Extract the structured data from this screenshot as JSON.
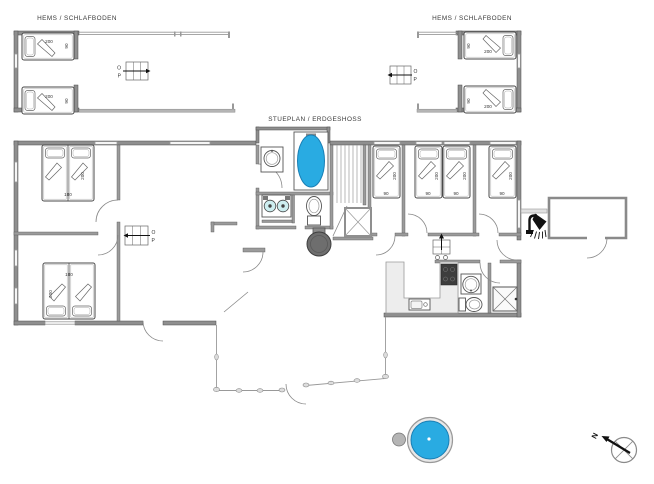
{
  "titles": {
    "loft_left": "HEMS / SCHLAFBODEN",
    "loft_right": "HEMS / SCHLAFBODEN",
    "main_floor": "STUEPLAN / ERDGESHOSS"
  },
  "stair_direction": {
    "up": "O",
    "down": "P"
  },
  "compass": {
    "north": "N"
  },
  "beds": {
    "loft_left_top": {
      "length": "200",
      "width": "90"
    },
    "loft_left_bottom": {
      "length": "200",
      "width": "90"
    },
    "loft_right_top": {
      "length": "200",
      "width": "90"
    },
    "loft_right_bottom": {
      "length": "200",
      "width": "90"
    },
    "bedroom_a": {
      "length": "200",
      "width": "180"
    },
    "bedroom_b": {
      "length": "200",
      "width": "180"
    },
    "bedroom_c": {
      "length": "200",
      "width": "90"
    },
    "bedroom_d_left": {
      "length": "200",
      "width": "90"
    },
    "bedroom_d_right": {
      "length": "200",
      "width": "90"
    },
    "bedroom_e": {
      "length": "200",
      "width": "90"
    }
  },
  "colors": {
    "water": "#29abe2",
    "water_border": "#1a7fb5",
    "stove_dark": "#3d3d3d"
  }
}
